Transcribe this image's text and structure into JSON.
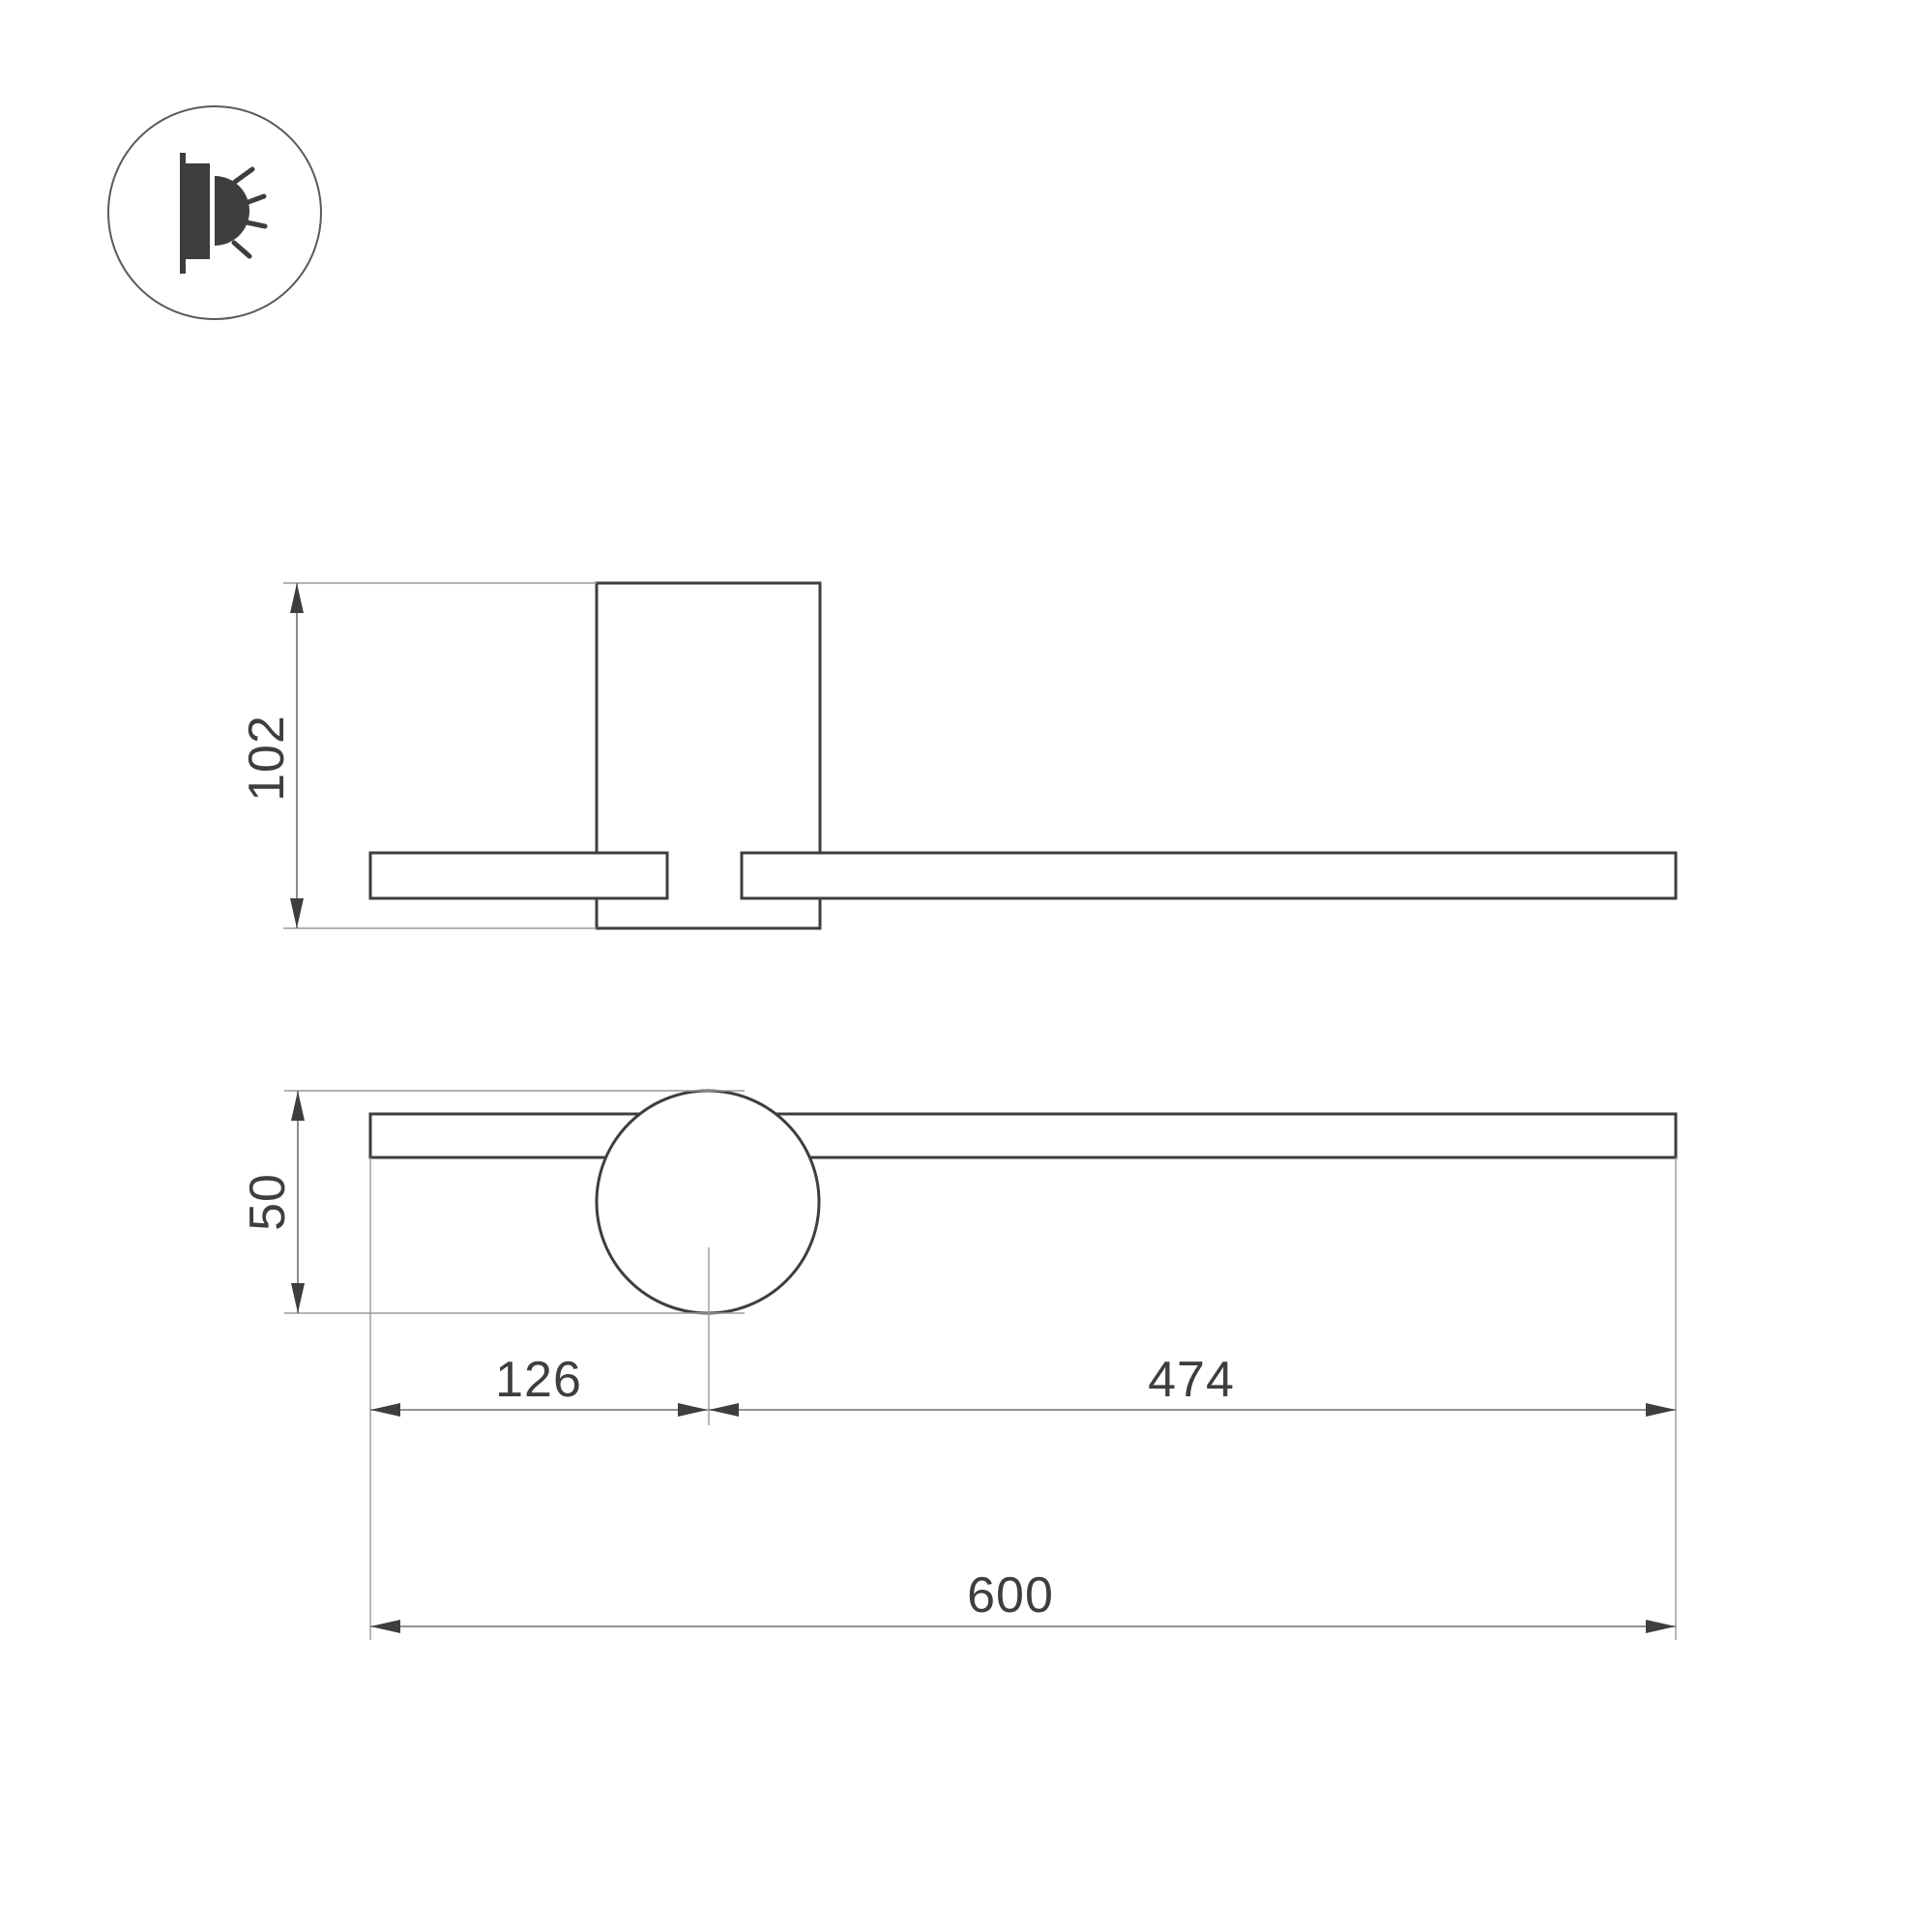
{
  "drawing": {
    "type": "technical-dimension-drawing",
    "background": "#ffffff"
  },
  "icon": {
    "name": "wall-light-side-glow-icon",
    "description": "circled pictogram of a wall-mounted luminaire emitting light rays"
  },
  "dimensions": {
    "side_height": "102",
    "front_height": "50",
    "center_offset_left": "126",
    "center_offset_right": "474",
    "total_length": "600"
  },
  "colors": {
    "outline": "#3e3e3e",
    "dimension_line": "#6e6e6e",
    "extension_line": "#9a9a9a",
    "text": "#3e3e3e",
    "icon_fill": "#3d3d3d",
    "icon_circle_stroke": "#5a5a5a"
  }
}
